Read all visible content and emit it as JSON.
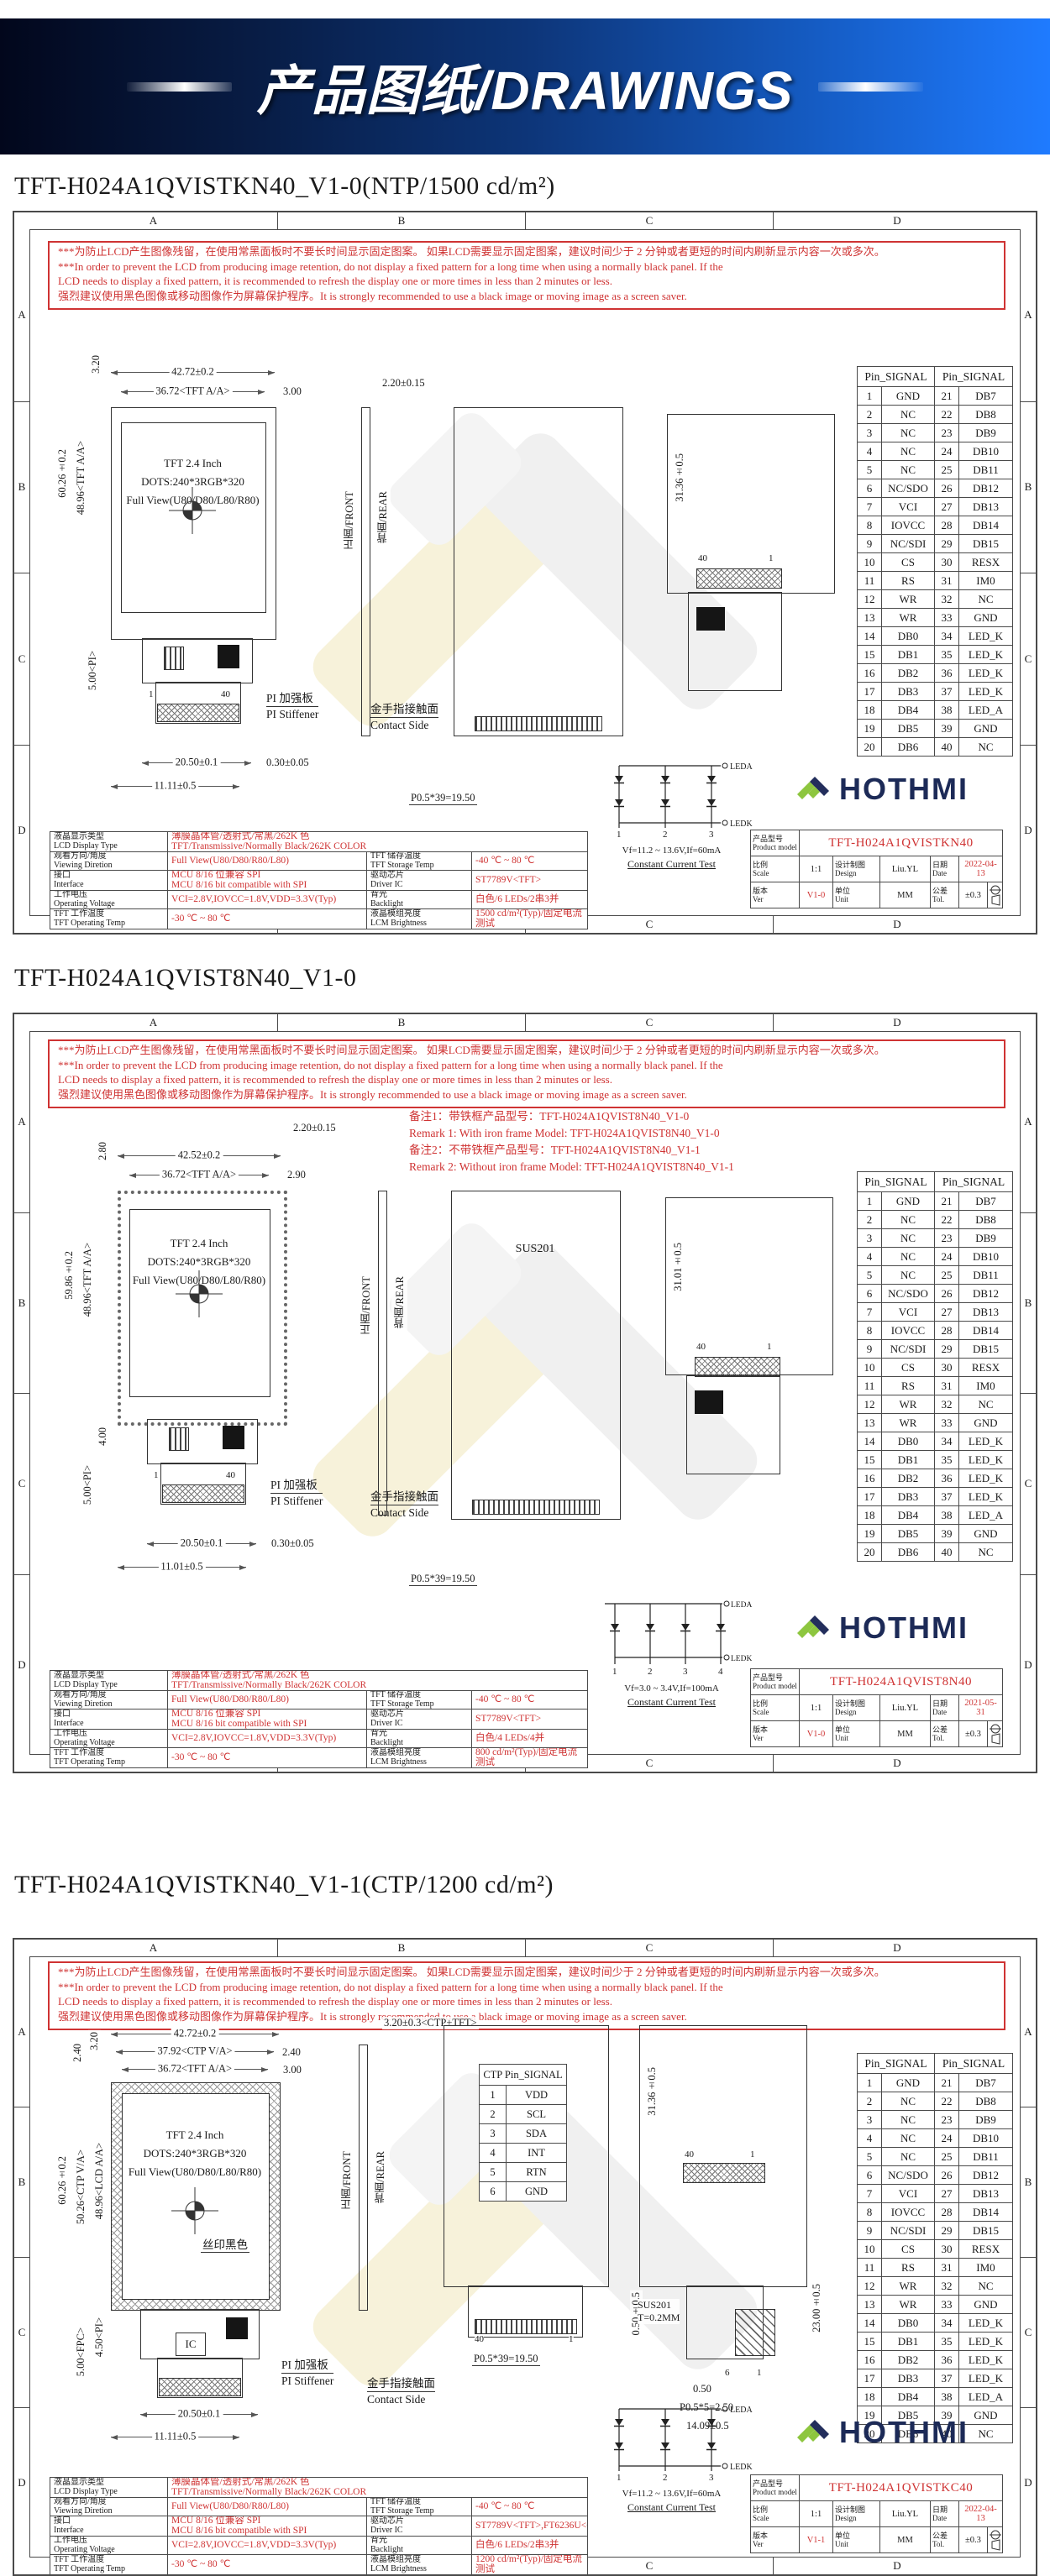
{
  "banner": {
    "title": "产品图纸/DRAWINGS"
  },
  "brand": {
    "name": "HOTHMI"
  },
  "frame": {
    "cols": [
      "A",
      "B",
      "C",
      "D"
    ],
    "rows": [
      "A",
      "B",
      "C",
      "D"
    ]
  },
  "warning": "***为防止LCD产生图像残留，在使用常黑面板时不要长时间显示固定图案。 如果LCD需要显示固定图案，建议时间少于 2 分钟或者更短的时间内刷新显示内容一次或多次。\n***In order to prevent the LCD from producing image retention, do not display a fixed pattern for a long time when using a normally black panel. If the\n LCD needs to display a fixed pattern, it is recommended to refresh the display one or more times in less than 2 minutes or less.\n强烈建议使用黑色图像或移动图像作为屏幕保护程序。It is strongly recommended to use a black image or moving image as a screen saver.",
  "pin_table": {
    "header": "Pin_SIGNAL",
    "rows": [
      [
        "1",
        "GND",
        "21",
        "DB7"
      ],
      [
        "2",
        "NC",
        "22",
        "DB8"
      ],
      [
        "3",
        "NC",
        "23",
        "DB9"
      ],
      [
        "4",
        "NC",
        "24",
        "DB10"
      ],
      [
        "5",
        "NC",
        "25",
        "DB11"
      ],
      [
        "6",
        "NC/SDO",
        "26",
        "DB12"
      ],
      [
        "7",
        "VCI",
        "27",
        "DB13"
      ],
      [
        "8",
        "IOVCC",
        "28",
        "DB14"
      ],
      [
        "9",
        "NC/SDI",
        "29",
        "DB15"
      ],
      [
        "10",
        "CS",
        "30",
        "RESX"
      ],
      [
        "11",
        "RS",
        "31",
        "IM0"
      ],
      [
        "12",
        "WR",
        "32",
        "NC"
      ],
      [
        "13",
        "WR",
        "33",
        "GND"
      ],
      [
        "14",
        "DB0",
        "34",
        "LED_K"
      ],
      [
        "15",
        "DB1",
        "35",
        "LED_K"
      ],
      [
        "16",
        "DB2",
        "36",
        "LED_K"
      ],
      [
        "17",
        "DB3",
        "37",
        "LED_K"
      ],
      [
        "18",
        "DB4",
        "38",
        "LED_A"
      ],
      [
        "19",
        "DB5",
        "39",
        "GND"
      ],
      [
        "20",
        "DB6",
        "40",
        "NC"
      ]
    ]
  },
  "tb_labels": {
    "model": "产品型号\nProduct model",
    "scale": "比例\nScale",
    "design": "设计制图\nDesign",
    "date": "日期\nDate",
    "ver": "版本\nVer",
    "unit": "单位\nUnit",
    "tol": "公差\nTol."
  },
  "led_labels": {
    "leda": "LEDA",
    "ledk": "LEDK"
  },
  "sheets": [
    {
      "title": "TFT-H024A1QVISTKN40_V1-0(NTP/1500 cd/m²)",
      "display": "TFT 2.4 Inch\nDOTS:240*3RGB*320\nFull View(U80/D80/L80/R80)",
      "dims": {
        "w": "42.72±0.2",
        "aa": "36.72<TFT A/A>",
        "gap": "3.00",
        "topv": "3.20",
        "aah": "48.96<TFT A/A>",
        "outh": "60.26±0.2",
        "pi": "5.00<PI>",
        "thick": "2.20±0.15",
        "fpcw": "20.50±0.1",
        "fpcoff": "11.11±0.5",
        "stiff": "0.30±0.05",
        "pitch": "P0.5*39=19.50",
        "rearh": "31.36±0.5"
      },
      "fpc_pins": {
        "first": "1",
        "last": "40"
      },
      "rear_pins": {
        "first": "40",
        "last": "1"
      },
      "labels": {
        "pi1": "PI 加强板",
        "pi2": "PI Stiffener",
        "c1": "金手指接触面",
        "c2": "Contact Side",
        "front": "正面/FRONT",
        "rear": "背面/REAR"
      },
      "spec": {
        "r1l": "液晶显示类型\nLCD Display Type",
        "r1v": "薄膜晶体管/透射式/常黑/262K 色\nTFT/Transmissive/Normally Black/262K COLOR",
        "rows": [
          [
            "观看方向/角度\nViewing Diretion",
            "Full View(U80/D80/R80/L80)",
            "TFT 储存温度\nTFT Storage Temp",
            "-40 ℃ ~ 80 ℃"
          ],
          [
            "接口\nInterface",
            "MCU 8/16 位兼容 SPI\nMCU 8/16 bit compatible with SPI",
            "驱动芯片\nDriver IC",
            "ST7789V<TFT>"
          ],
          [
            "工作电压\nOperating Voltage",
            "VCI=2.8V,IOVCC=1.8V,VDD=3.3V(Typ)",
            "背光\nBacklight",
            "白色/6 LEDs/2串3并"
          ],
          [
            "TFT 工作温度\nTFT Operating Temp",
            "-30 ℃ ~ 80 ℃",
            "液晶模组亮度\nLCM Brightness",
            "1500 cd/m²(Typ)/固定电流测试"
          ]
        ]
      },
      "led": {
        "pins": [
          "1",
          "2",
          "3"
        ],
        "vf": "Vf=11.2 ~ 13.6V,If=60mA",
        "note": "Constant Current Test"
      },
      "tb": {
        "model": "TFT-H024A1QVISTKN40",
        "scale": "1:1",
        "design": "Liu.YL",
        "date": "2022-04-13",
        "ver": "V1-0",
        "unit": "MM",
        "tol": "±0.3"
      }
    },
    {
      "title": "TFT-H024A1QVIST8N40_V1-0",
      "remarks": "备注1：带铁框产品型号：TFT-H024A1QVIST8N40_V1-0\nRemark 1: With iron frame Model: TFT-H024A1QVIST8N40_V1-0\n备注2：不带铁框产品型号：TFT-H024A1QVIST8N40_V1-1\nRemark 2: Without iron frame Model: TFT-H024A1QVIST8N40_V1-1",
      "display": "TFT 2.4 Inch\nDOTS:240*3RGB*320\nFull View(U80/D80/L80/R80)",
      "dims": {
        "w": "42.52±0.2",
        "aa": "36.72<TFT A/A>",
        "gap": "2.90",
        "topv": "2.80",
        "aah": "48.96<TFT A/A>",
        "outh": "59.86±0.2",
        "d4": "4.00",
        "pi": "5.00<PI>",
        "thick": "2.20±0.15",
        "fpcw": "20.50±0.1",
        "fpcoff": "11.01±0.5",
        "stiff": "0.30±0.05",
        "pitch": "P0.5*39=19.50",
        "rearh": "31.01±0.5"
      },
      "fpc_pins": {
        "first": "1",
        "last": "40"
      },
      "rear_pins": {
        "first": "40",
        "last": "1"
      },
      "rear_label": "SUS201",
      "labels": {
        "pi1": "PI 加强板",
        "pi2": "PI Stiffener",
        "c1": "金手指接触面",
        "c2": "Contact Side",
        "front": "正面/FRONT",
        "rear": "背面/REAR"
      },
      "spec": {
        "r1l": "液晶显示类型\nLCD Display Type",
        "r1v": "薄膜晶体管/透射式/常黑/262K 色\nTFT/Transmissive/Normally Black/262K COLOR",
        "rows": [
          [
            "观看方向/角度\nViewing Diretion",
            "Full View(U80/D80/R80/L80)",
            "TFT 储存温度\nTFT Storage Temp",
            "-40 ℃ ~ 80 ℃"
          ],
          [
            "接口\nInterface",
            "MCU 8/16 位兼容 SPI\nMCU 8/16 bit compatible with SPI",
            "驱动芯片\nDriver IC",
            "ST7789V<TFT>"
          ],
          [
            "工作电压\nOperating Voltage",
            "VCI=2.8V,IOVCC=1.8V,VDD=3.3V(Typ)",
            "背光\nBacklight",
            "白色/4 LEDs/4并"
          ],
          [
            "TFT 工作温度\nTFT Operating Temp",
            "-30 ℃ ~ 80 ℃",
            "液晶模组亮度\nLCM Brightness",
            "800 cd/m²(Typ)/固定电流测试"
          ]
        ]
      },
      "led": {
        "pins": [
          "1",
          "2",
          "3",
          "4"
        ],
        "vf": "Vf=3.0 ~ 3.4V,If=100mA",
        "note": "Constant Current Test"
      },
      "tb": {
        "model": "TFT-H024A1QVIST8N40",
        "scale": "1:1",
        "design": "Liu.YL",
        "date": "2021-05-31",
        "ver": "V1-0",
        "unit": "MM",
        "tol": "±0.3"
      }
    },
    {
      "title": "TFT-H024A1QVISTKN40_V1-1(CTP/1200 cd/m²)",
      "display": "TFT 2.4 Inch\nDOTS:240*3RGB*320\nFull View(U80/D80/L80/R80)",
      "dims": {
        "w": "42.72±0.2",
        "ctp": "37.92<CTP V/A>",
        "ctpgap": "2.40",
        "aa": "36.72<TFT A/A>",
        "gap": "3.00",
        "topv1": "3.20",
        "topv2": "2.40",
        "lcdaa": "48.96<LCD A/A>",
        "ctpva": "50.26<CTP V/A>",
        "outh": "60.26±0.2",
        "pi": "4.50<PI>",
        "fpc": "5.00<FPC>",
        "thick": "3.20±0.3<CTP+TFT>",
        "fpcw": "20.50±0.1",
        "fpcoff": "11.11±0.5",
        "pitch": "P0.5*39=19.50",
        "rearh": "31.36±0.5",
        "d23": "23.00±0.5",
        "d05a": "0.50±0.5",
        "d05b": "0.50",
        "p5": "P0.5*5=2.50",
        "d1409": "14.09±0.5"
      },
      "silk": "丝印黑色",
      "ic": "IC",
      "sus": "SUS201\nT=0.2MM",
      "rear_pins": {
        "first": "40",
        "last": "1"
      },
      "rear_pins6": {
        "first": "6",
        "last": "1"
      },
      "ctp": {
        "header": "CTP Pin_SIGNAL",
        "rows": [
          [
            "1",
            "VDD"
          ],
          [
            "2",
            "SCL"
          ],
          [
            "3",
            "SDA"
          ],
          [
            "4",
            "INT"
          ],
          [
            "5",
            "RTN"
          ],
          [
            "6",
            "GND"
          ]
        ]
      },
      "labels": {
        "pi1": "PI 加强板",
        "pi2": "PI Stiffener",
        "c1": "金手指接触面",
        "c2": "Contact Side",
        "front": "正面/FRONT",
        "rear": "背面/REAR"
      },
      "spec": {
        "r1l": "液晶显示类型\nLCD Display Type",
        "r1v": "薄膜晶体管/透射式/常黑/262K 色\nTFT/Transmissive/Normally Black/262K COLOR",
        "rows": [
          [
            "观看方向/角度\nViewing Diretion",
            "Full View(U80/D80/R80/L80)",
            "TFT 储存温度\nTFT Storage Temp",
            "-40 ℃ ~ 80 ℃"
          ],
          [
            "接口\nInterface",
            "MCU 8/16 位兼容 SPI\nMCU 8/16 bit compatible with SPI",
            "驱动芯片\nDriver IC",
            "ST7789V<TFT>,FT6236U<CTP>"
          ],
          [
            "工作电压\nOperating Voltage",
            "VCI=2.8V,IOVCC=1.8V,VDD=3.3V(Typ)",
            "背光\nBacklight",
            "白色/6 LEDs/2串3并"
          ],
          [
            "TFT 工作温度\nTFT Operating Temp",
            "-30 ℃ ~ 80 ℃",
            "液晶模组亮度\nLCM Brightness",
            "1200 cd/m²(Typ)/固定电流测试"
          ]
        ]
      },
      "led": {
        "pins": [
          "1",
          "2",
          "3"
        ],
        "vf": "Vf=11.2 ~ 13.6V,If=60mA",
        "note": "Constant Current Test"
      },
      "tb": {
        "model": "TFT-H024A1QVISTKC40",
        "scale": "1:1",
        "design": "Liu.YL",
        "date": "2022-04-13",
        "ver": "V1-1",
        "unit": "MM",
        "tol": "±0.3"
      }
    }
  ]
}
